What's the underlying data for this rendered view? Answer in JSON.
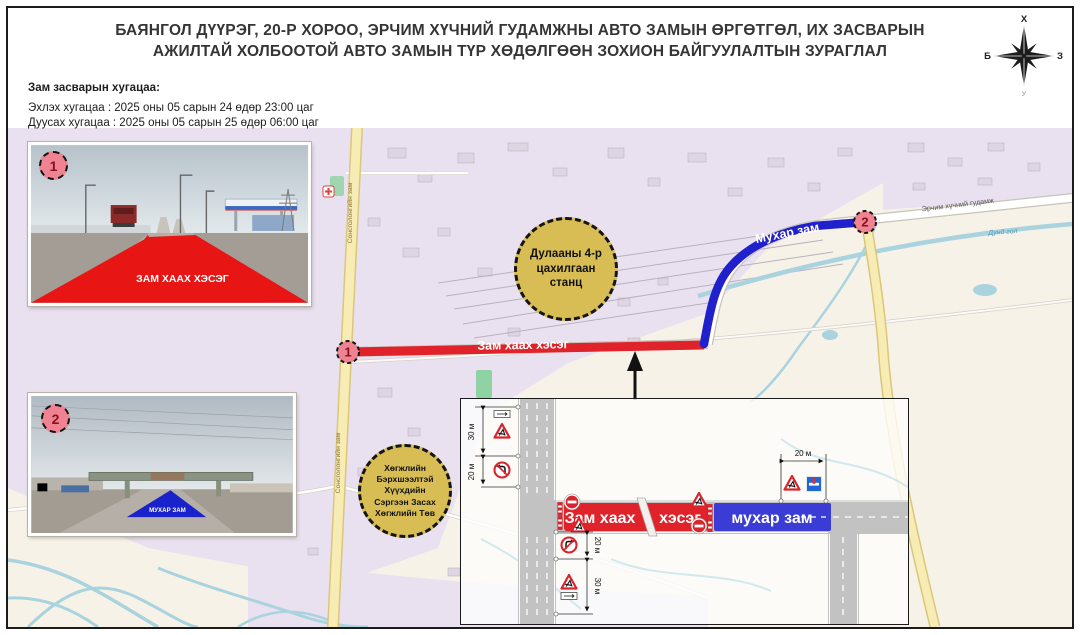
{
  "title": {
    "line1": "БАЯНГОЛ ДҮҮРЭГ, 20-Р ХОРОО, ЭРЧИМ ХҮЧНИЙ ГУДАМЖНЫ АВТО ЗАМЫН ӨРГӨТГӨЛ, ИХ ЗАСВАРЫН",
    "line2": "АЖИЛТАЙ ХОЛБООТОЙ АВТО ЗАМЫН ТҮР ХӨДӨЛГӨӨН ЗОХИОН БАЙГУУЛАЛТЫН ЗУРАГЛАЛ"
  },
  "compass": {
    "north": "Х",
    "west": "Б",
    "east": "З",
    "south": "У"
  },
  "schedule": {
    "heading": "Зам засварын хугацаа:",
    "start_line": "Эхлэх хугацаа : 2025 оны 05 сарын 24 өдөр 23:00 цаг",
    "end_line": "Дуусах хугацаа : 2025 оны 05 сарын 25 өдөр 06:00 цаг"
  },
  "map": {
    "marker1": "1",
    "marker2": "2",
    "closed_section_label": "Зам хаах хэсэг",
    "dead_end_label": "Мухар зам",
    "street_left": "Сонсголонгийн зам",
    "street_top_right": "Эрчим хүчний гудамж",
    "river_label": "Дунд гол",
    "poi_power_station": "Дулааны 4-р цахилгаан станц",
    "poi_rehab_lines": [
      "Хөгжлийн",
      "Бэрхшээлтэй",
      "Хүүхдийн",
      "Сэргээн Засах",
      "Хөгжлийн Төв"
    ]
  },
  "photos": {
    "photo1_marker": "1",
    "photo1_overlay": "ЗАМ ХААХ ХЭСЭГ",
    "photo2_marker": "2",
    "photo2_overlay": "МУХАР ЗАМ"
  },
  "inset": {
    "closed_left": "Зам хаах",
    "closed_right": "хэсэг",
    "dead_end": "мухар зам",
    "dim_top_30": "30 м",
    "dim_top_20": "20 м",
    "dim_bottom_20": "20 м",
    "dim_bottom_30": "30 м",
    "dim_right_20": "20 м"
  },
  "colors": {
    "closed_red": "#e0232a",
    "dead_end_blue": "#3b3bd6",
    "poi_fill": "#d8bd55",
    "marker_pink": "#ef8391"
  }
}
